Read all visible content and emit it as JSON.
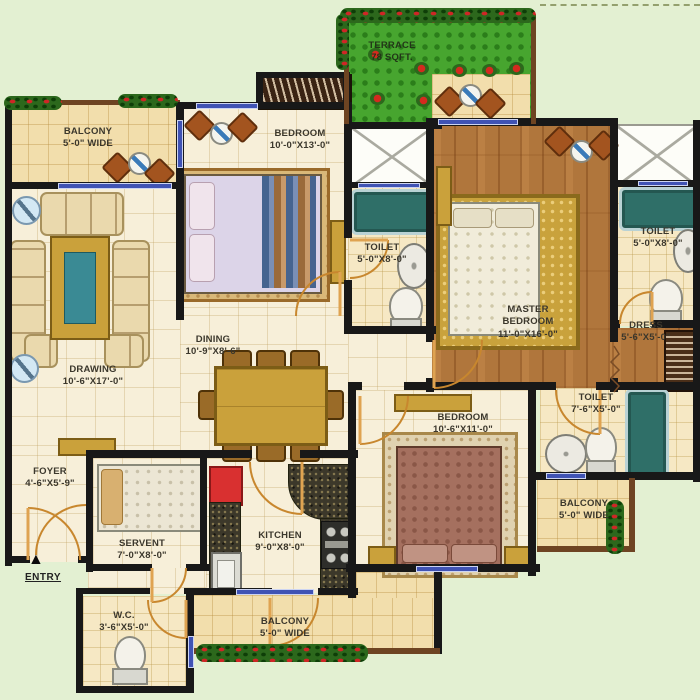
{
  "rooms": {
    "balcony_top_left": {
      "name": "BALCONY",
      "dims": "5'-0\" WIDE"
    },
    "bedroom_top": {
      "name": "BEDROOM",
      "dims": "10'-0\"X13'-0\""
    },
    "terrace": {
      "name": "TERRACE",
      "dims": "78 SQFT."
    },
    "toilet_top": {
      "name": "TOILET",
      "dims": "5'-0\"X8'-0\""
    },
    "master_bedroom": {
      "name": "MASTER BEDROOM",
      "dims": "11'-0\"X16'-0\""
    },
    "toilet_master": {
      "name": "TOILET",
      "dims": "5'-0\"X8'-0\""
    },
    "dress": {
      "name": "DRESS",
      "dims": "5'-6\"X5'-0\""
    },
    "drawing": {
      "name": "DRAWING",
      "dims": "10'-6\"X17'-0\""
    },
    "dining": {
      "name": "DINING",
      "dims": "10'-9\"X8'-6\""
    },
    "bedroom_bottom": {
      "name": "BEDROOM",
      "dims": "10'-6\"X11'-0\""
    },
    "toilet_common": {
      "name": "TOILET",
      "dims": "7'-6\"X5'-0\""
    },
    "foyer": {
      "name": "FOYER",
      "dims": "4'-6\"X5'-9\""
    },
    "servant": {
      "name": "SERVENT",
      "dims": "7'-0\"X8'-0\""
    },
    "kitchen": {
      "name": "KITCHEN",
      "dims": "9'-0\"X8'-0\""
    },
    "wc": {
      "name": "W.C.",
      "dims": "3'-6\"X5'-0\""
    },
    "balcony_bottom": {
      "name": "BALCONY",
      "dims": "5'-0\" WIDE"
    },
    "balcony_right": {
      "name": "BALCONY",
      "dims": "5'-0\" WIDE"
    }
  },
  "entry": {
    "label": "ENTRY",
    "arrow": "▲"
  },
  "colors": {
    "wall": "#181818",
    "floor_cream": "#f7efd9",
    "floor_balcony": "#f2deac",
    "wood": "#b0763c",
    "grass_green": "#47a52f",
    "window_blue": "#4053b4",
    "bathtub_teal": "#2f6f68",
    "fridge_red": "#d93030",
    "furniture_gold": "#caa13b",
    "background_green": "#e3f0d2"
  }
}
